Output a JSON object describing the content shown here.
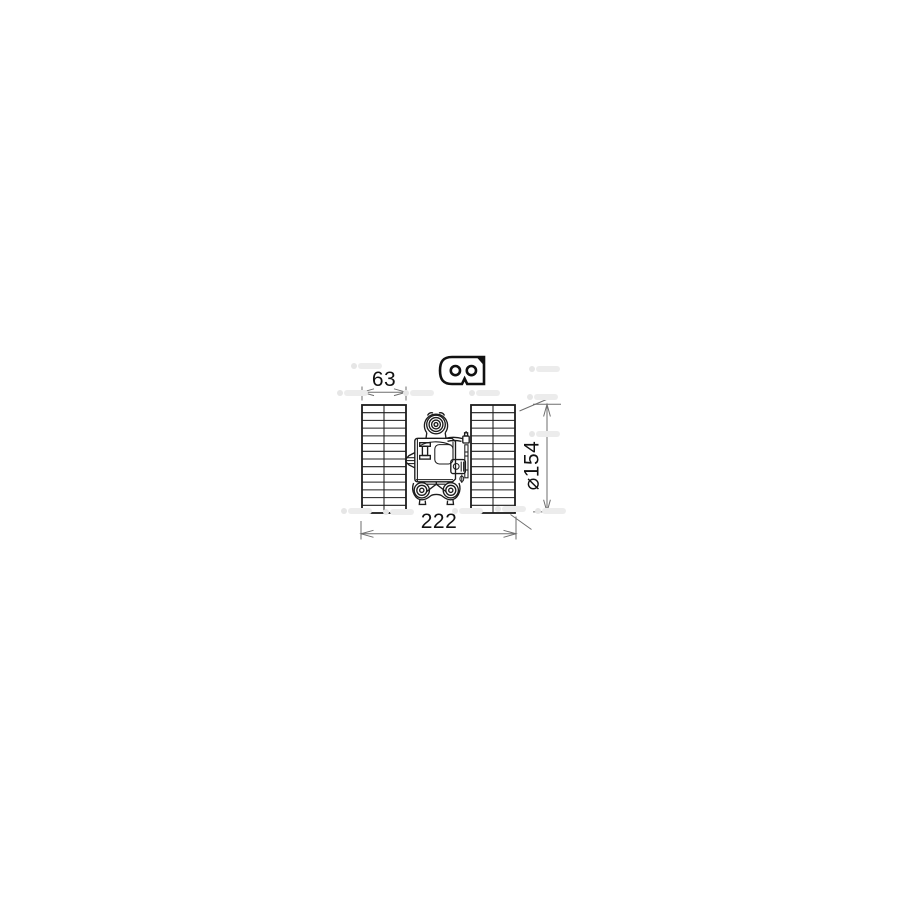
{
  "page": {
    "background": "#ffffff"
  },
  "drawing": {
    "colors": {
      "part_line": "#1c1c1c",
      "dimension_line": "#6e6e6e",
      "label_text": "#111111",
      "watermark": "#ececec"
    },
    "labels": {
      "width_left": "63",
      "width_overall": "222",
      "diameter": "⌀154"
    },
    "icons": [
      {
        "name": "two-pin-connector-icon"
      },
      {
        "name": "fan-cage-left"
      },
      {
        "name": "fan-cage-right"
      },
      {
        "name": "blower-motor-assembly"
      }
    ]
  }
}
